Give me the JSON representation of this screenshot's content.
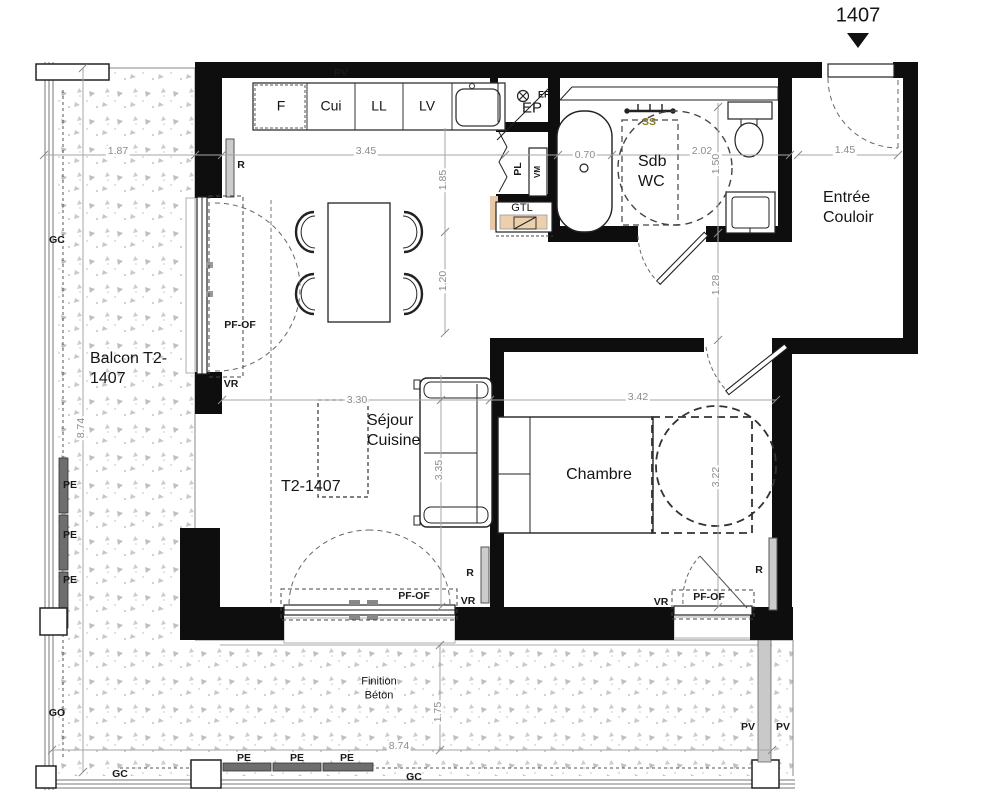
{
  "unit": {
    "number": "1407"
  },
  "rooms": {
    "balcony": "Balcon T2-\n1407",
    "living": "Séjour\nCuisine",
    "living_unit": "T2-1407",
    "bedroom": "Chambre",
    "bathroom": "Sdb\nWC",
    "entry": "Entrée\nCouloir",
    "finish_note": "Finition\nBéton"
  },
  "kitchen": {
    "units": [
      "F",
      "Cui",
      "LL",
      "LV"
    ]
  },
  "tech": {
    "ep": "EP",
    "ep_small": "EP",
    "pl": "PL",
    "vm": "VM",
    "gtl": "GTL",
    "ss": "SS",
    "pv": "PV",
    "gc": "GC",
    "go": "GO",
    "pe": "PE",
    "r": "R",
    "vr": "VR",
    "pf_of": "PF-OF"
  },
  "dims": {
    "balcony_top": "1.87",
    "kitchen": "3.45",
    "kitchen_depth": "1.85",
    "tub": "0.70",
    "bathroom": "2.02",
    "bathroom_depth": "1.50",
    "entry": "1.45",
    "living_mid": "1.20",
    "hallway": "1.28",
    "living_width": "3.30",
    "bedroom_width": "3.42",
    "living_depth": "3.35",
    "bedroom_depth": "3.22",
    "balcony_side": "8.74",
    "balcony_bottom": "8.74",
    "balcony_bottom_depth": "1.75"
  },
  "colors": {
    "wall": "#0e0e0e",
    "gtl_fill": "#ecd0ae",
    "radiator": "#cccccc",
    "dim_text": "#8c8c8c"
  }
}
